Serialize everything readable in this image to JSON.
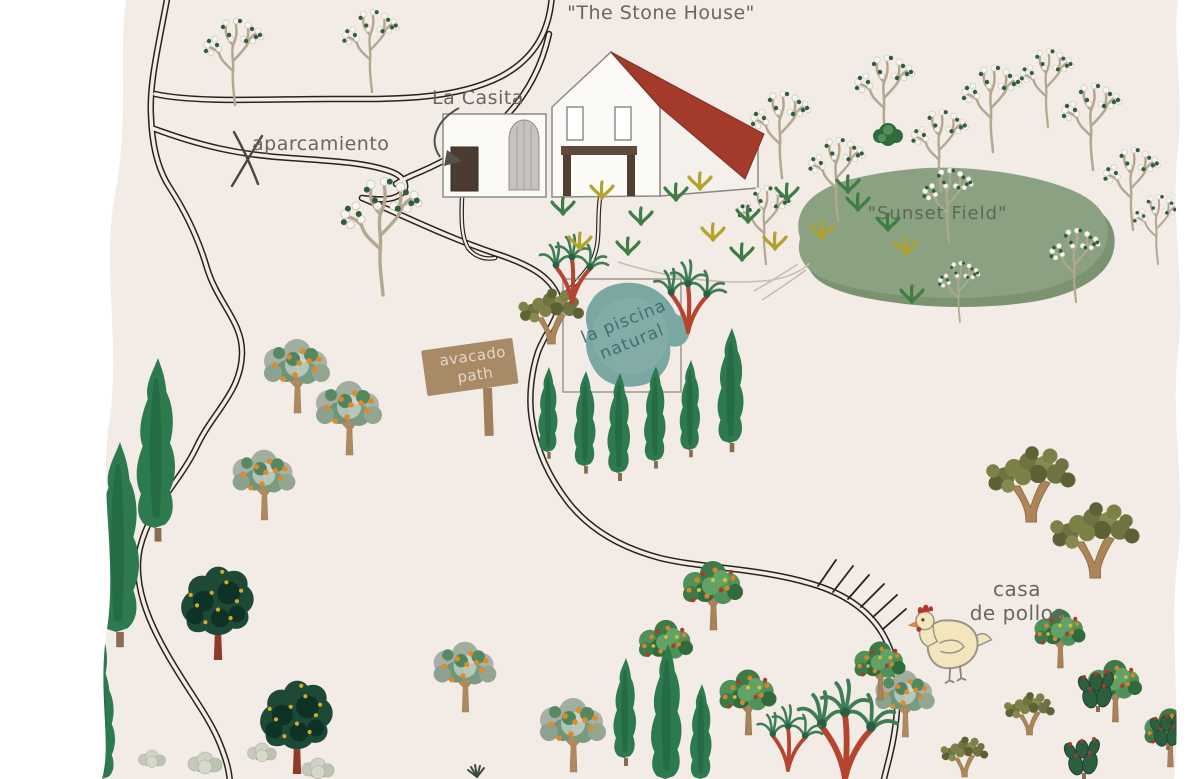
{
  "labels": {
    "stone_house": "\"The Stone House\"",
    "la_casita": "La Casita",
    "parking": "aparcamiento",
    "sunset_field": "\"Sunset Field\"",
    "pool": {
      "line1": "la piscina",
      "line2": "natural"
    },
    "sign": {
      "line1": "avacado",
      "line2": "path"
    },
    "chicken_house": {
      "line1": "casa",
      "line2": "de pollos"
    }
  },
  "map_icons": [
    "cypress-tree",
    "orange-tree",
    "almond-tree",
    "olive-tree",
    "palm-tree",
    "cactus",
    "dark-green-tree",
    "fruit-tree",
    "pale-shrub",
    "plant-tuft",
    "chicken",
    "wooden-sign",
    "x-marker",
    "arrow"
  ],
  "colors": {
    "background": "#f2ebe6",
    "paper_edge": "#ffffff",
    "road": "#26221f",
    "roof": "#a43b2a",
    "wall": "#fcfaf7",
    "field": "#8ba282",
    "field_shadow": "#7b9370",
    "pool": "#7ba7a3",
    "pool_text": "#3e6f76",
    "sign": "#a98a67",
    "sign_text": "#e3d7c5",
    "label_text": "#6b6460",
    "field_text": "#5b6a54",
    "chicken_body": "#f3e6bd",
    "comb": "#b5372a"
  }
}
